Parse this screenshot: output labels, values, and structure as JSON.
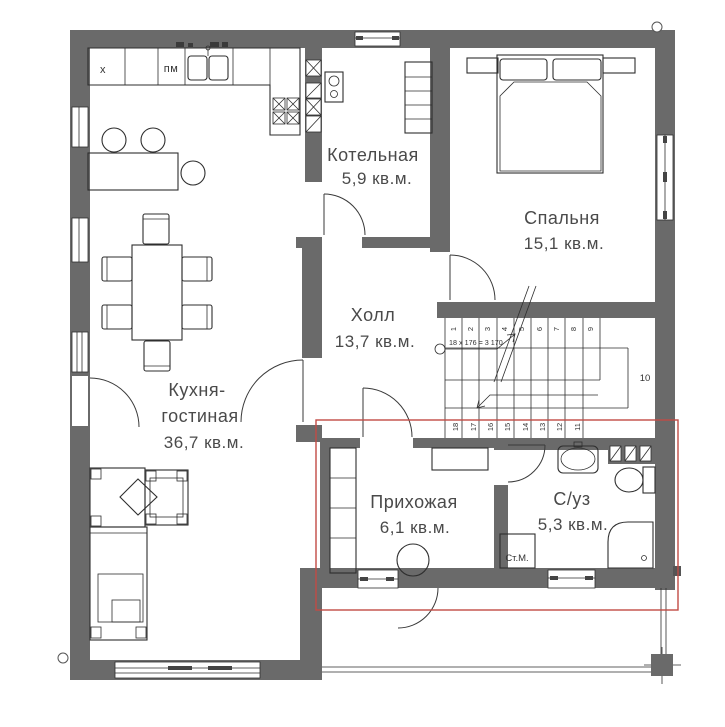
{
  "rooms": {
    "boiler": {
      "name": "Котельная",
      "area": "5,9 кв.м."
    },
    "bedroom": {
      "name": "Спальня",
      "area": "15,1 кв.м."
    },
    "hall": {
      "name": "Холл",
      "area": "13,7 кв.м."
    },
    "kitchen_living": {
      "name1": "Кухня-",
      "name2": "гостиная",
      "area": "36,7 кв.м."
    },
    "entry": {
      "name": "Прихожая",
      "area": "6,1 кв.м."
    },
    "bathroom": {
      "name": "С/уз",
      "area": "5,3 кв.м."
    }
  },
  "labels": {
    "washing_machine": "Ст.М.",
    "fridge": "х",
    "dishwasher": "пм"
  },
  "stairs": {
    "formula": "18 х 176 = 3 170",
    "landing": "10",
    "upper": [
      "1",
      "2",
      "3",
      "4",
      "5",
      "6",
      "7",
      "8",
      "9"
    ],
    "lower": [
      "18",
      "17",
      "16",
      "15",
      "14",
      "13",
      "12",
      "11"
    ]
  },
  "colors": {
    "wall": "#6a6a6a",
    "line": "#2e2e2e",
    "label": "#4a4a4a",
    "highlight": "#c14b45",
    "background": "#ffffff"
  }
}
